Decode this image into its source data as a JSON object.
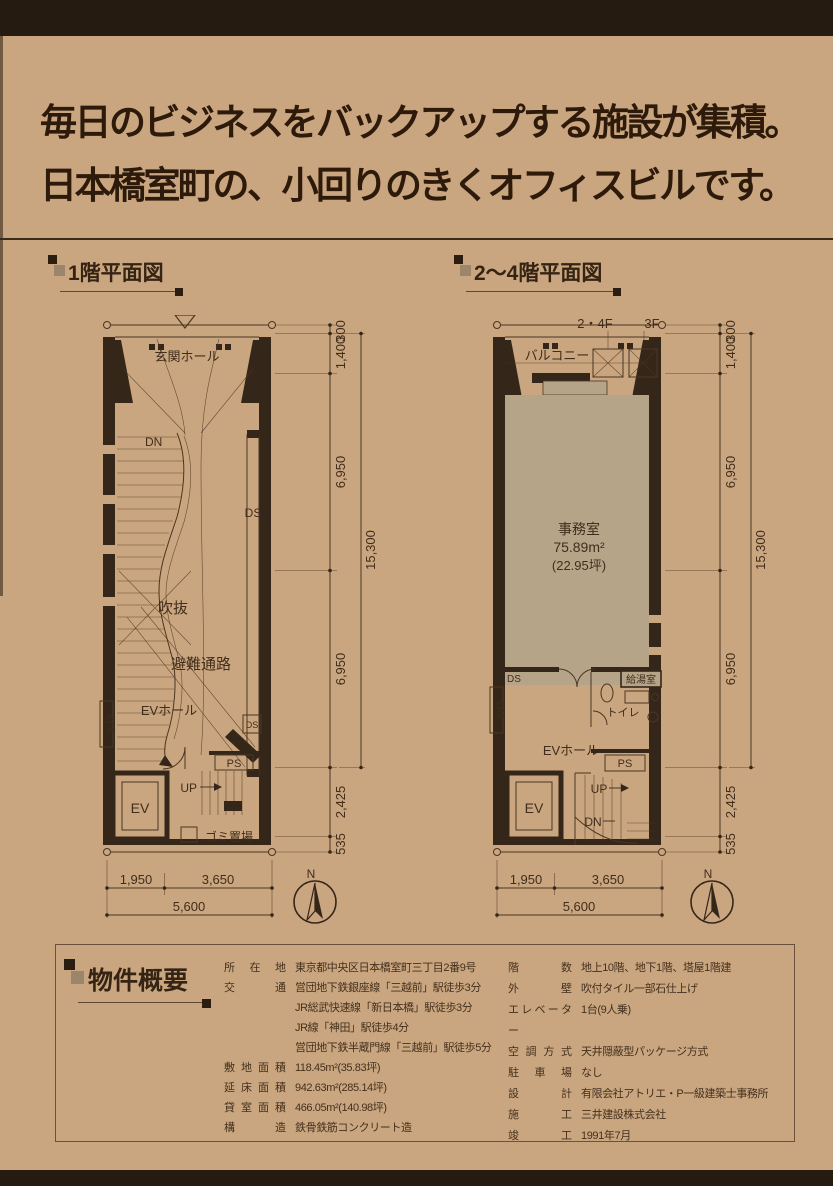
{
  "headline": {
    "line1": "毎日のビジネスをバックアップする施設が集積。",
    "line2": "日本橋室町の、小回りのきくオフィスビルです。"
  },
  "plan1": {
    "title": "1階平面図",
    "labels": {
      "entrance_hall": "玄関ホール",
      "dn": "DN",
      "ds_shaft": "DS",
      "atrium": "吹抜",
      "evac_route": "避難通路",
      "ev_hall": "EVホール",
      "eps": "EPS",
      "ds_small": "DS",
      "ps": "PS",
      "up": "UP",
      "ev": "EV",
      "garbage": "ゴミ置場"
    }
  },
  "plan2": {
    "title": "2〜4階平面図",
    "labels": {
      "f24": "2・4F",
      "f3": "3F",
      "balcony": "バルコニー",
      "office": "事務室",
      "office_area": "75.89m²",
      "office_tsubo": "(22.95坪)",
      "ds": "DS",
      "eps": "EPS",
      "kitchen": "給湯室",
      "toilet": "トイレ",
      "ev_hall": "EVホール",
      "ps": "PS",
      "up": "UP",
      "dn": "DN",
      "ev": "EV"
    }
  },
  "dims": {
    "v300": "300",
    "v1400": "1,400",
    "v6950": "6,950",
    "v15300": "15,300",
    "v2425": "2,425",
    "v535": "535",
    "h1950": "1,950",
    "h3650": "3,650",
    "h5600": "5,600",
    "north": "N"
  },
  "overview": {
    "title": "物件概要",
    "left": [
      {
        "label": "所在地",
        "value": "東京都中央区日本橋室町三丁目2番9号"
      },
      {
        "label": "交通",
        "value": "営団地下鉄銀座線「三越前」駅徒歩3分"
      },
      {
        "label": "",
        "value": "JR総武快速線「新日本橋」駅徒歩3分"
      },
      {
        "label": "",
        "value": "JR線「神田」駅徒歩4分"
      },
      {
        "label": "",
        "value": "営団地下鉄半蔵門線「三越前」駅徒歩5分"
      },
      {
        "label": "敷地面積",
        "value": "118.45m²(35.83坪)"
      },
      {
        "label": "延床面積",
        "value": "942.63m²(285.14坪)"
      },
      {
        "label": "貸室面積",
        "value": "466.05m²(140.98坪)"
      },
      {
        "label": "構造",
        "value": "鉄骨鉄筋コンクリート造"
      }
    ],
    "right": [
      {
        "label": "階数",
        "value": "地上10階、地下1階、塔屋1階建"
      },
      {
        "label": "外壁",
        "value": "吹付タイル一部石仕上げ"
      },
      {
        "label": "エレベーター",
        "value": "1台(9人乗)"
      },
      {
        "label": "空調方式",
        "value": "天井隠蔽型パッケージ方式"
      },
      {
        "label": "駐車場",
        "value": "なし"
      },
      {
        "label": "設計",
        "value": "有限会社アトリエ・P一級建築士事務所"
      },
      {
        "label": "施工",
        "value": "三井建設株式会社"
      },
      {
        "label": "竣工",
        "value": "1991年7月"
      }
    ]
  }
}
